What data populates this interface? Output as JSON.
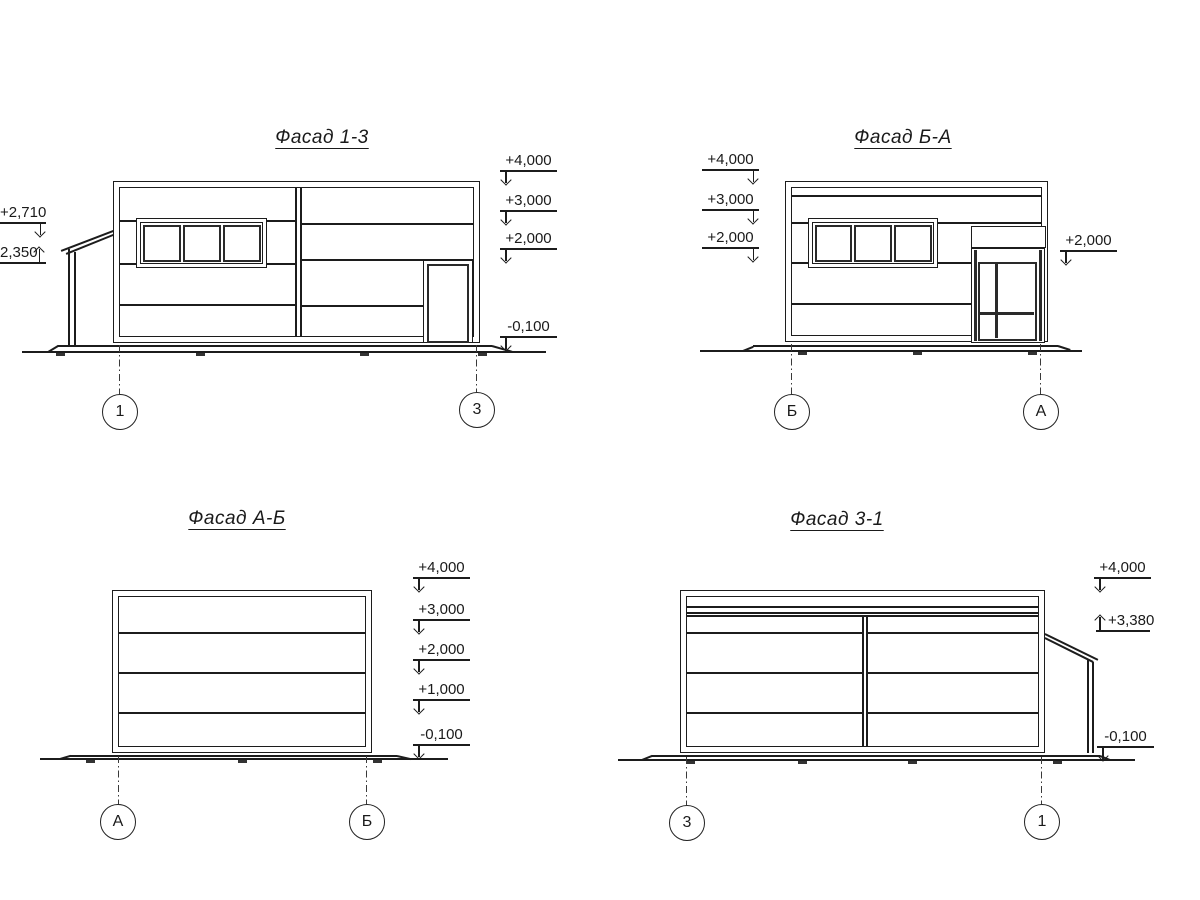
{
  "drawing": {
    "facades": [
      {
        "id": "facade-1-3",
        "title": "Фасад 1-3",
        "axes": [
          {
            "label": "1"
          },
          {
            "label": "3"
          }
        ],
        "marks_right": [
          "+4,000",
          "+3,000",
          "+2,000",
          "-0,100"
        ],
        "marks_left": [
          "+2,710",
          "2,350"
        ]
      },
      {
        "id": "facade-b-a",
        "title": "Фасад Б-А",
        "axes": [
          {
            "label": "Б"
          },
          {
            "label": "А"
          }
        ],
        "marks_left": [
          "+4,000",
          "+3,000",
          "+2,000"
        ],
        "marks_right": [
          "+2,000"
        ]
      },
      {
        "id": "facade-a-b",
        "title": "Фасад А-Б",
        "axes": [
          {
            "label": "А"
          },
          {
            "label": "Б"
          }
        ],
        "marks_right": [
          "+4,000",
          "+3,000",
          "+2,000",
          "+1,000",
          "-0,100"
        ]
      },
      {
        "id": "facade-3-1",
        "title": "Фасад 3-1",
        "axes": [
          {
            "label": "3"
          },
          {
            "label": "1"
          }
        ],
        "marks_right": [
          "+4,000",
          "+3,380",
          "-0,100"
        ]
      }
    ]
  }
}
